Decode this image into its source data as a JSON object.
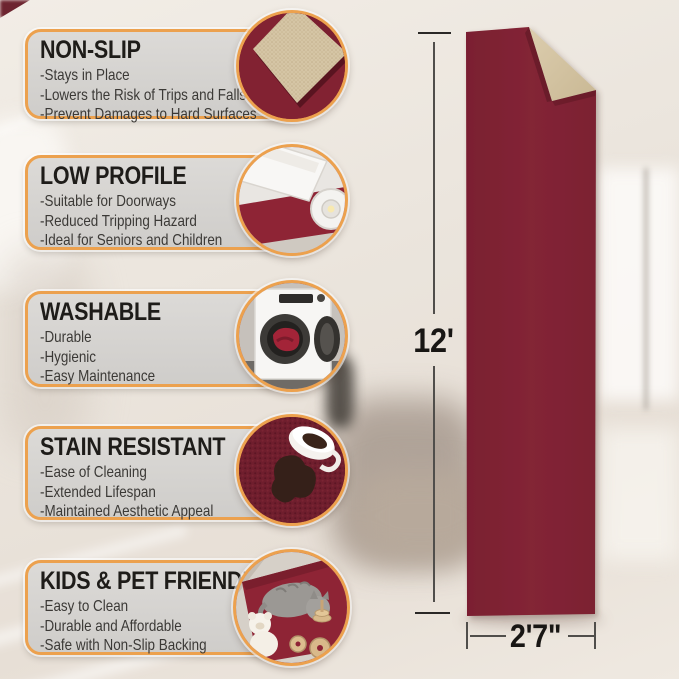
{
  "colors": {
    "accent_border": "#ECA14E",
    "panel_bg": "#D5D3D0",
    "title_text": "#1E1C19",
    "body_text": "#3B3936",
    "rug_red": "#802334",
    "rug_backing": "#D5C5A5",
    "dimension_text": "#181614"
  },
  "features": [
    {
      "title": "NON-SLIP",
      "icon": "folded-rug-corner-photo",
      "items": [
        "-Stays in Place",
        "-Lowers the Risk of Trips and Falls",
        "-Prevent Damages to Hard Surfaces"
      ]
    },
    {
      "title": "LOW PROFILE",
      "icon": "door-clearance-photo",
      "items": [
        "-Suitable for Doorways",
        "-Reduced Tripping Hazard",
        "-Ideal for Seniors and Children"
      ]
    },
    {
      "title": "WASHABLE",
      "icon": "washing-machine-photo",
      "items": [
        "-Durable",
        "-Hygienic",
        "-Easy Maintenance"
      ]
    },
    {
      "title": "STAIN RESISTANT",
      "icon": "coffee-spill-photo",
      "items": [
        "-Ease of Cleaning",
        "-Extended Lifespan",
        "-Maintained Aesthetic Appeal"
      ]
    },
    {
      "title": "KIDS & PET FRIENDLY",
      "icon": "cat-and-toys-photo",
      "items": [
        "-Easy to Clean",
        "-Durable and Affordable",
        "-Safe with Non-Slip Backing"
      ]
    }
  ],
  "rug": {
    "height_label": "12'",
    "width_label": "2'7\""
  }
}
